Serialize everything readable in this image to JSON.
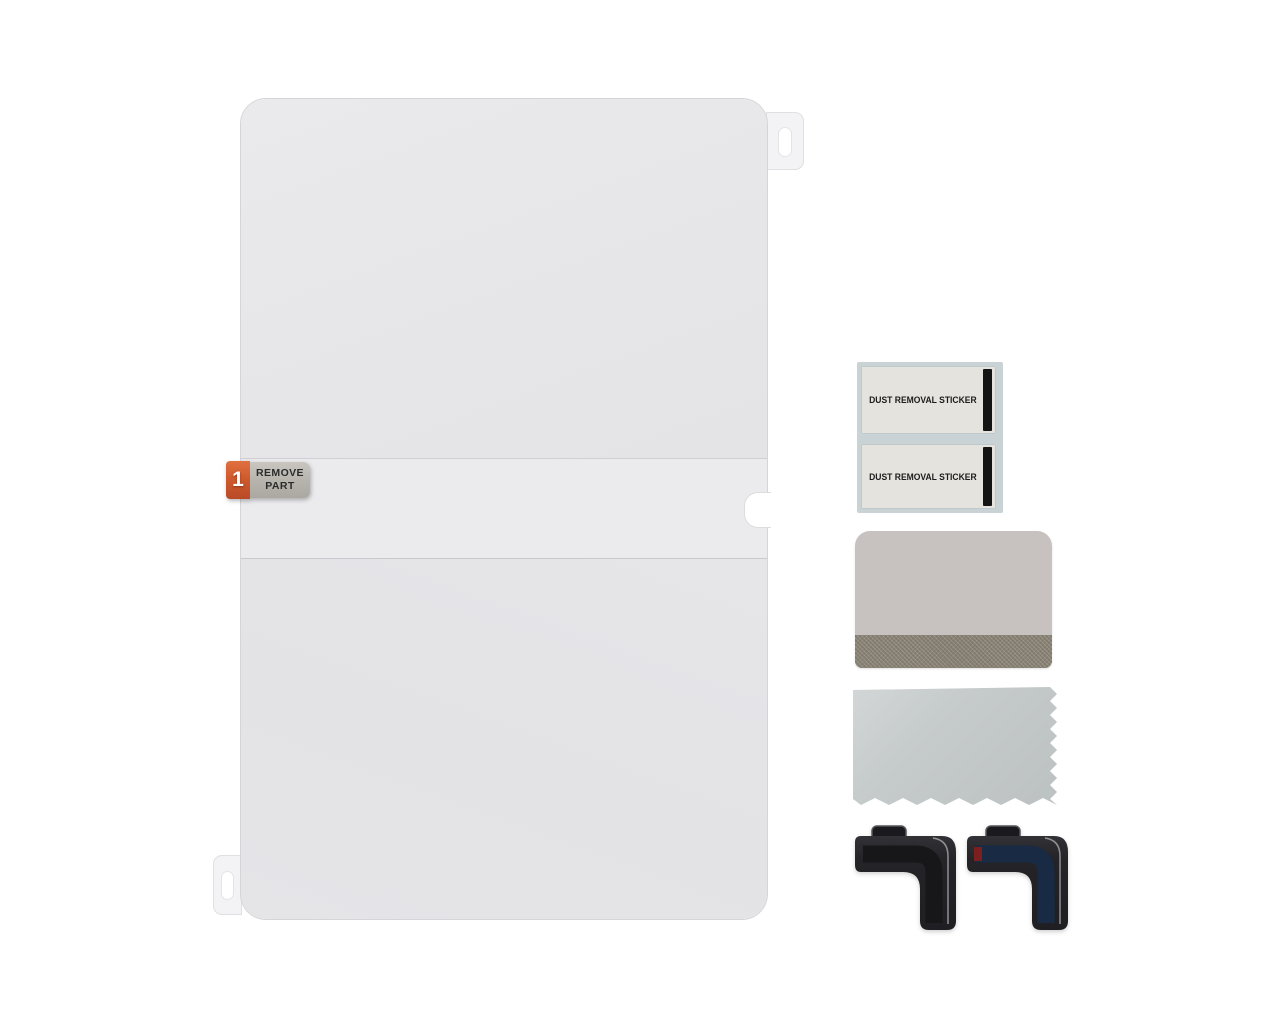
{
  "scene": {
    "title": "Tablet screen protector installation kit",
    "background_color": "#ffffff"
  },
  "film": {
    "description": "screen protector film with peel layers",
    "top_layer_color": "#e7e7e9",
    "middle_band_color": "#ebebee",
    "bottom_layer_color": "#e4e4e7",
    "edge_color": "#d5d5d9",
    "tab_color": "#f3f3f5",
    "step_badge": {
      "number": "1",
      "color": "#cf5a2e",
      "text_color": "#ffffff"
    },
    "remove_part_label": {
      "line1": "REMOVE",
      "line2": "PART",
      "bg_color": "#b5b3ab",
      "text_color": "#2b2b2b"
    }
  },
  "dust_stickers": {
    "sheet_color": "#c9d2d5",
    "card_color": "#e4e3de",
    "stripe_color": "#141414",
    "text_color": "#1b1b1b",
    "items": [
      {
        "label": "DUST REMOVAL STICKER"
      },
      {
        "label": "DUST REMOVAL STICKER"
      }
    ]
  },
  "squeegee": {
    "body_color": "#c7c2c0",
    "felt_color": "#8e8678"
  },
  "cloth": {
    "color": "#c6cbcb"
  },
  "corner_guides": {
    "body_color": "#242428",
    "clip_color": "#1a1a1e",
    "edge_line_color": "#b5b5b8",
    "left": {
      "channel_color": "#17171a"
    },
    "right": {
      "channel_color": "#182a44",
      "accent_color": "#7c1f1f"
    }
  }
}
